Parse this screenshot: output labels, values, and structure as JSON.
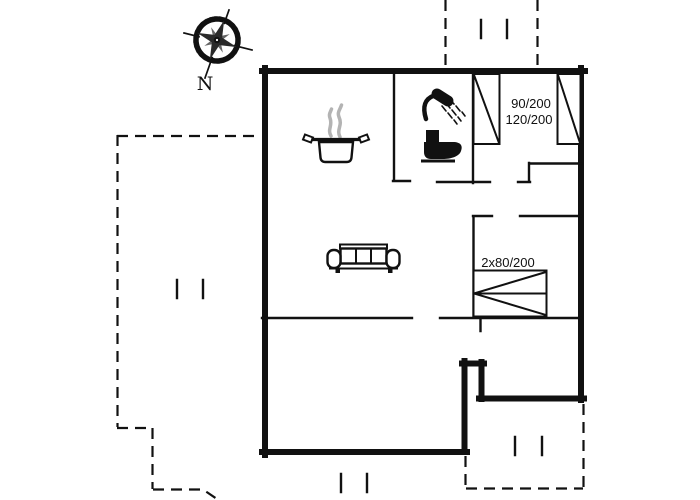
{
  "colors": {
    "ink": "#111111",
    "steam": "#b3b3b3",
    "background": "#ffffff"
  },
  "compass": {
    "north_label": "N"
  },
  "rooms": {
    "bedroom_top_right": {
      "bed_labels": [
        "90/200",
        "120/200"
      ]
    },
    "bedroom_middle_right": {
      "bed_label": "2x80/200"
    }
  },
  "icons": {
    "compass_rose": "compass-rose",
    "cooking_pot": "cooking-pot",
    "steam": "steam",
    "shower": "shower",
    "toilet": "toilet",
    "sofa": "sofa",
    "beds": "bed-rectangles-with-diagonal",
    "terrace": "dashed-terrace-outline"
  }
}
